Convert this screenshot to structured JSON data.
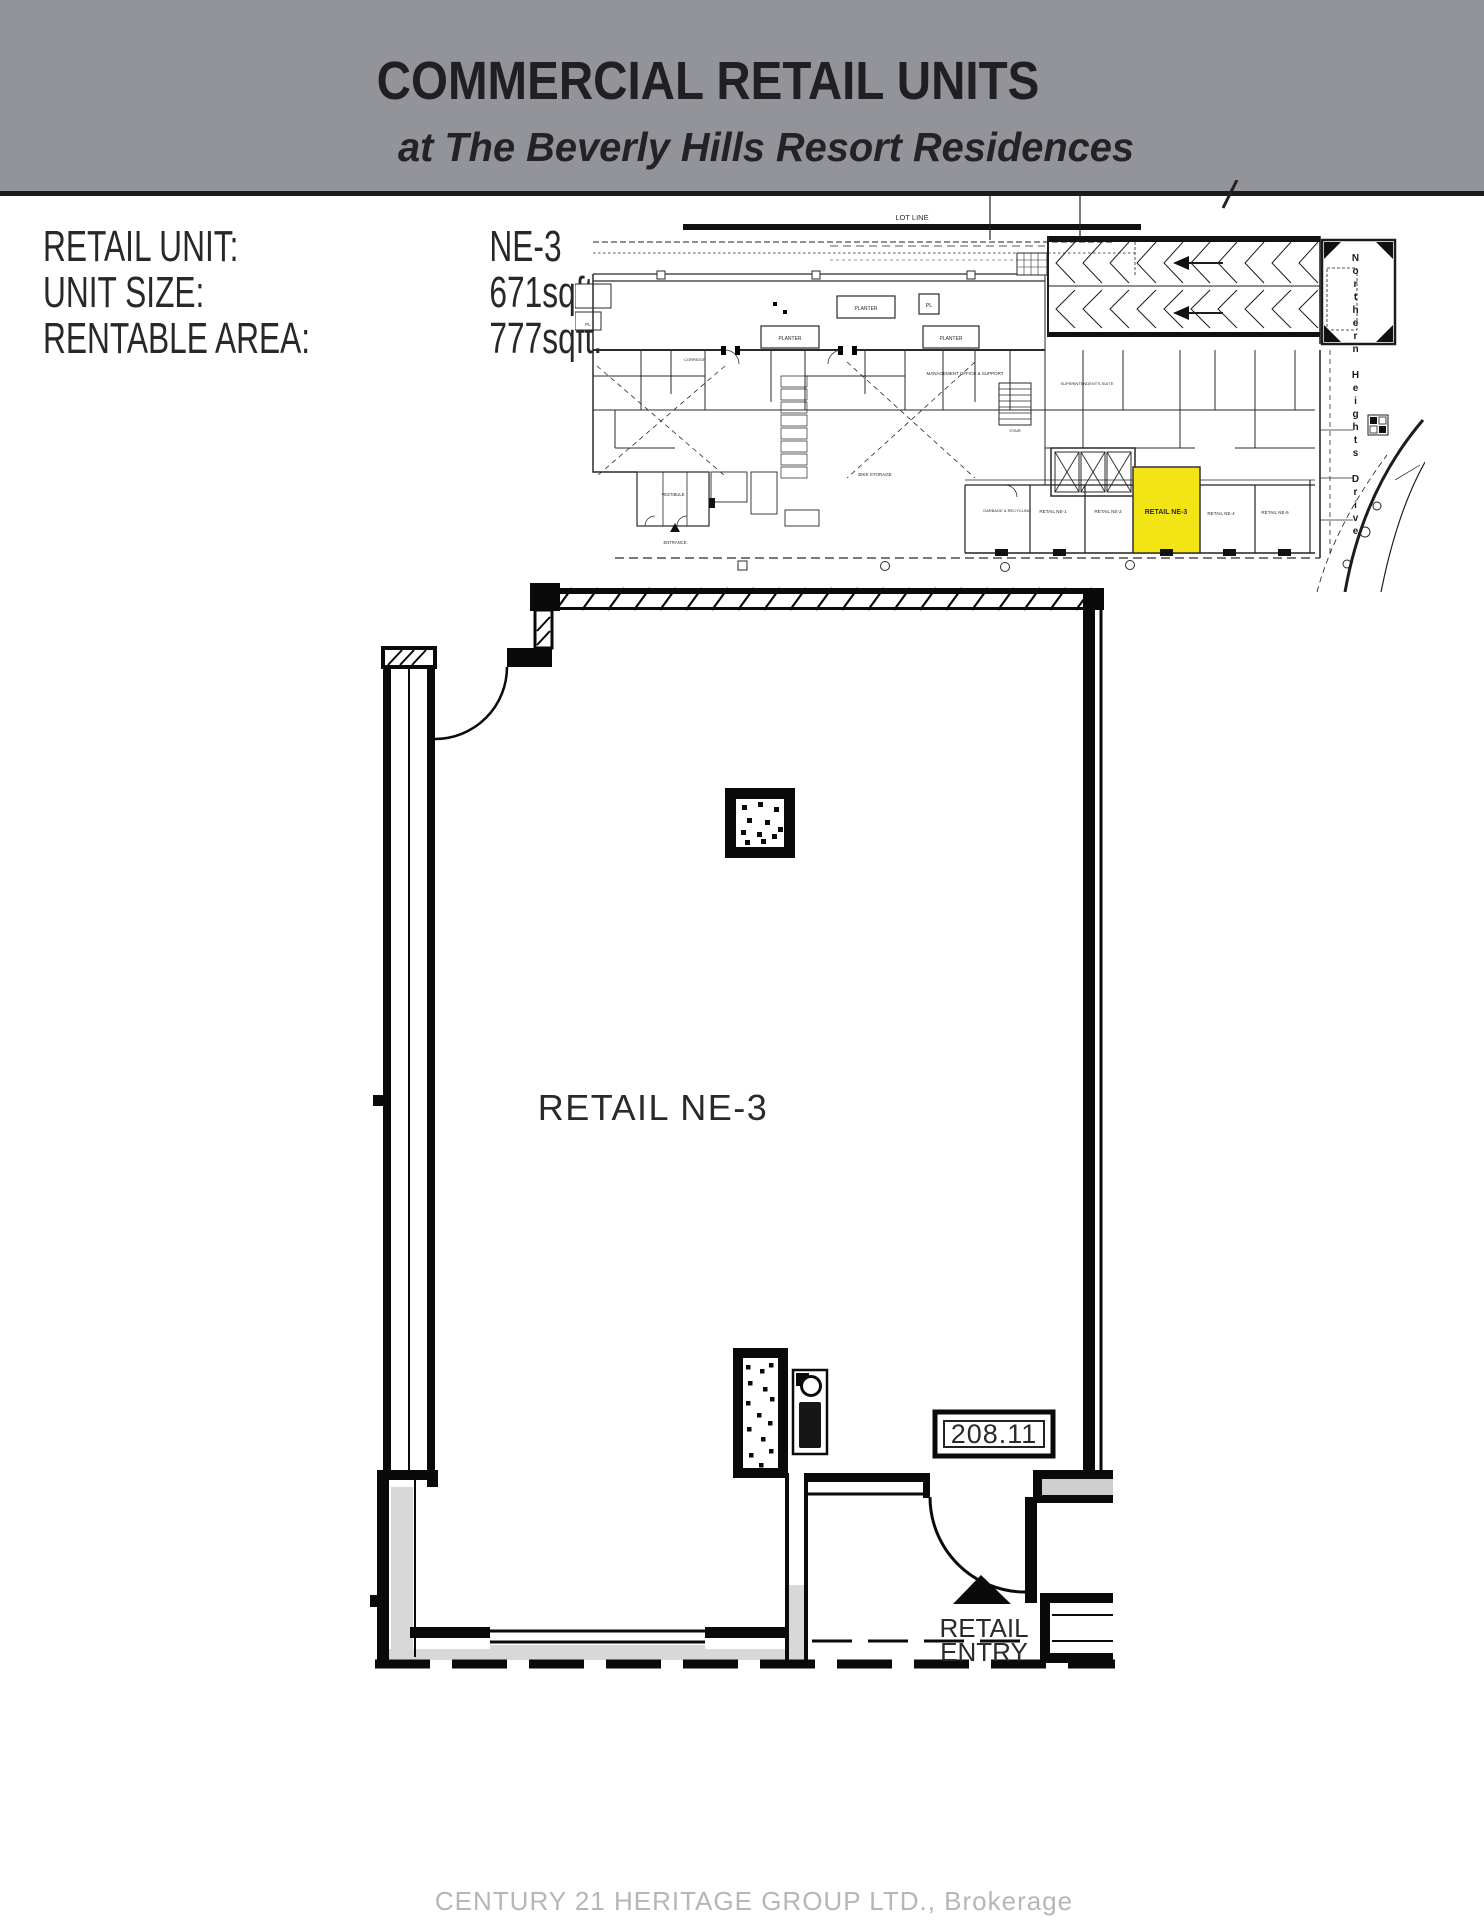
{
  "header": {
    "title": "COMMERCIAL RETAIL UNITS",
    "subtitle": "at The Beverly Hills Resort Residences"
  },
  "info": {
    "rows": [
      {
        "label": "RETAIL UNIT:",
        "value": "NE-3"
      },
      {
        "label": "UNIT SIZE:",
        "value": "671sqft."
      },
      {
        "label": "RENTABLE AREA:",
        "value": "777sqft."
      }
    ]
  },
  "site_plan": {
    "lot_line_label": "LOT LINE",
    "planter_label": "PLANTER",
    "pl_label": "PL",
    "corridor_label": "CORRIDOR",
    "bike_storage_label": "BIKE STORAGE",
    "management_office_label": "MANAGEMENT OFFICE & SUPPORT",
    "superintendent_label": "SUPERINTENDENT'S SUITE",
    "stair_label": "STAIR",
    "elevator_lobby_label": "ELEVATOR LOBBY",
    "garbage_label": "GARBAGE & RECYCLING",
    "vestibule_label": "VESTIBULE",
    "entrance_label": "ENTRANCE",
    "street_name": "Northern Heights Drive",
    "units": [
      {
        "label": "RETAIL NE-1"
      },
      {
        "label": "RETAIL NE-2"
      },
      {
        "label": "RETAIL NE-3"
      },
      {
        "label": "RETAIL NE-4"
      },
      {
        "label": "RETAIL NE-5"
      }
    ],
    "highlighted_unit": "RETAIL NE-3",
    "highlight_color": "#f3e515"
  },
  "floor_plan": {
    "unit_label": "RETAIL NE-3",
    "dimension_label": "208.11",
    "entry_label_line1": "RETAIL",
    "entry_label_line2": "ENTRY"
  },
  "footer": {
    "watermark": "CENTURY 21 HERITAGE GROUP LTD., Brokerage"
  }
}
